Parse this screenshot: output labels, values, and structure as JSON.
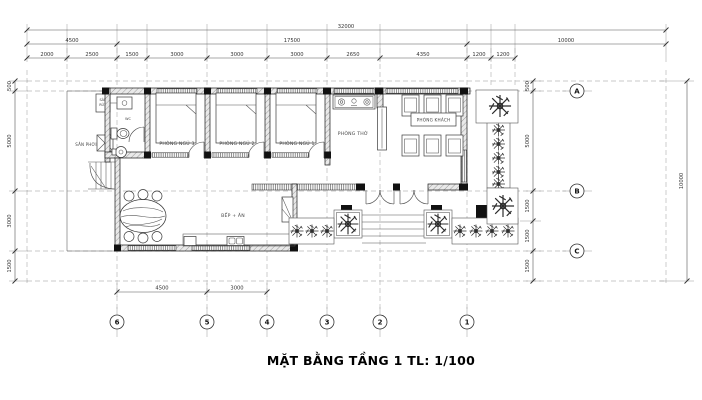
{
  "drawing": {
    "title": "MẶT BẰNG TẦNG 1 TL: 1/100"
  },
  "rooms": {
    "san_phoi": "SÂN PHƠI",
    "san_rua_line1": "SÂN",
    "san_rua_line2": "RỬA",
    "wc": "WC",
    "bedroom3": "PHÒNG NGỦ 3",
    "bedroom2": "PHÒNG NGỦ 2",
    "bedroom1": "PHÒNG NGỦ 1",
    "worship": "PHÒNG THỜ",
    "living": "PHÒNG KHÁCH",
    "kitchen": "BẾP + ĂN"
  },
  "dims": {
    "total": "32000",
    "row2": [
      "4500",
      "17500",
      "10000"
    ],
    "row3": [
      "2000",
      "2500",
      "1500",
      "3000",
      "3000",
      "3000",
      "2650",
      "4350",
      "1200",
      "1200"
    ],
    "left": [
      "500",
      "5000",
      "3000",
      "1500"
    ],
    "right_inner": [
      "500",
      "5000",
      "1500",
      "1500",
      "1500"
    ],
    "right_outer": "10000",
    "bottom": [
      "4500",
      "3000"
    ]
  },
  "grid": {
    "letters": [
      "A",
      "B",
      "C"
    ],
    "numbers": [
      "6",
      "5",
      "4",
      "3",
      "2",
      "1"
    ]
  },
  "colors": {
    "line": "#333333",
    "wall_fill": "#e8e8e8",
    "dash": "#b9b9b9",
    "text": "#222222"
  }
}
